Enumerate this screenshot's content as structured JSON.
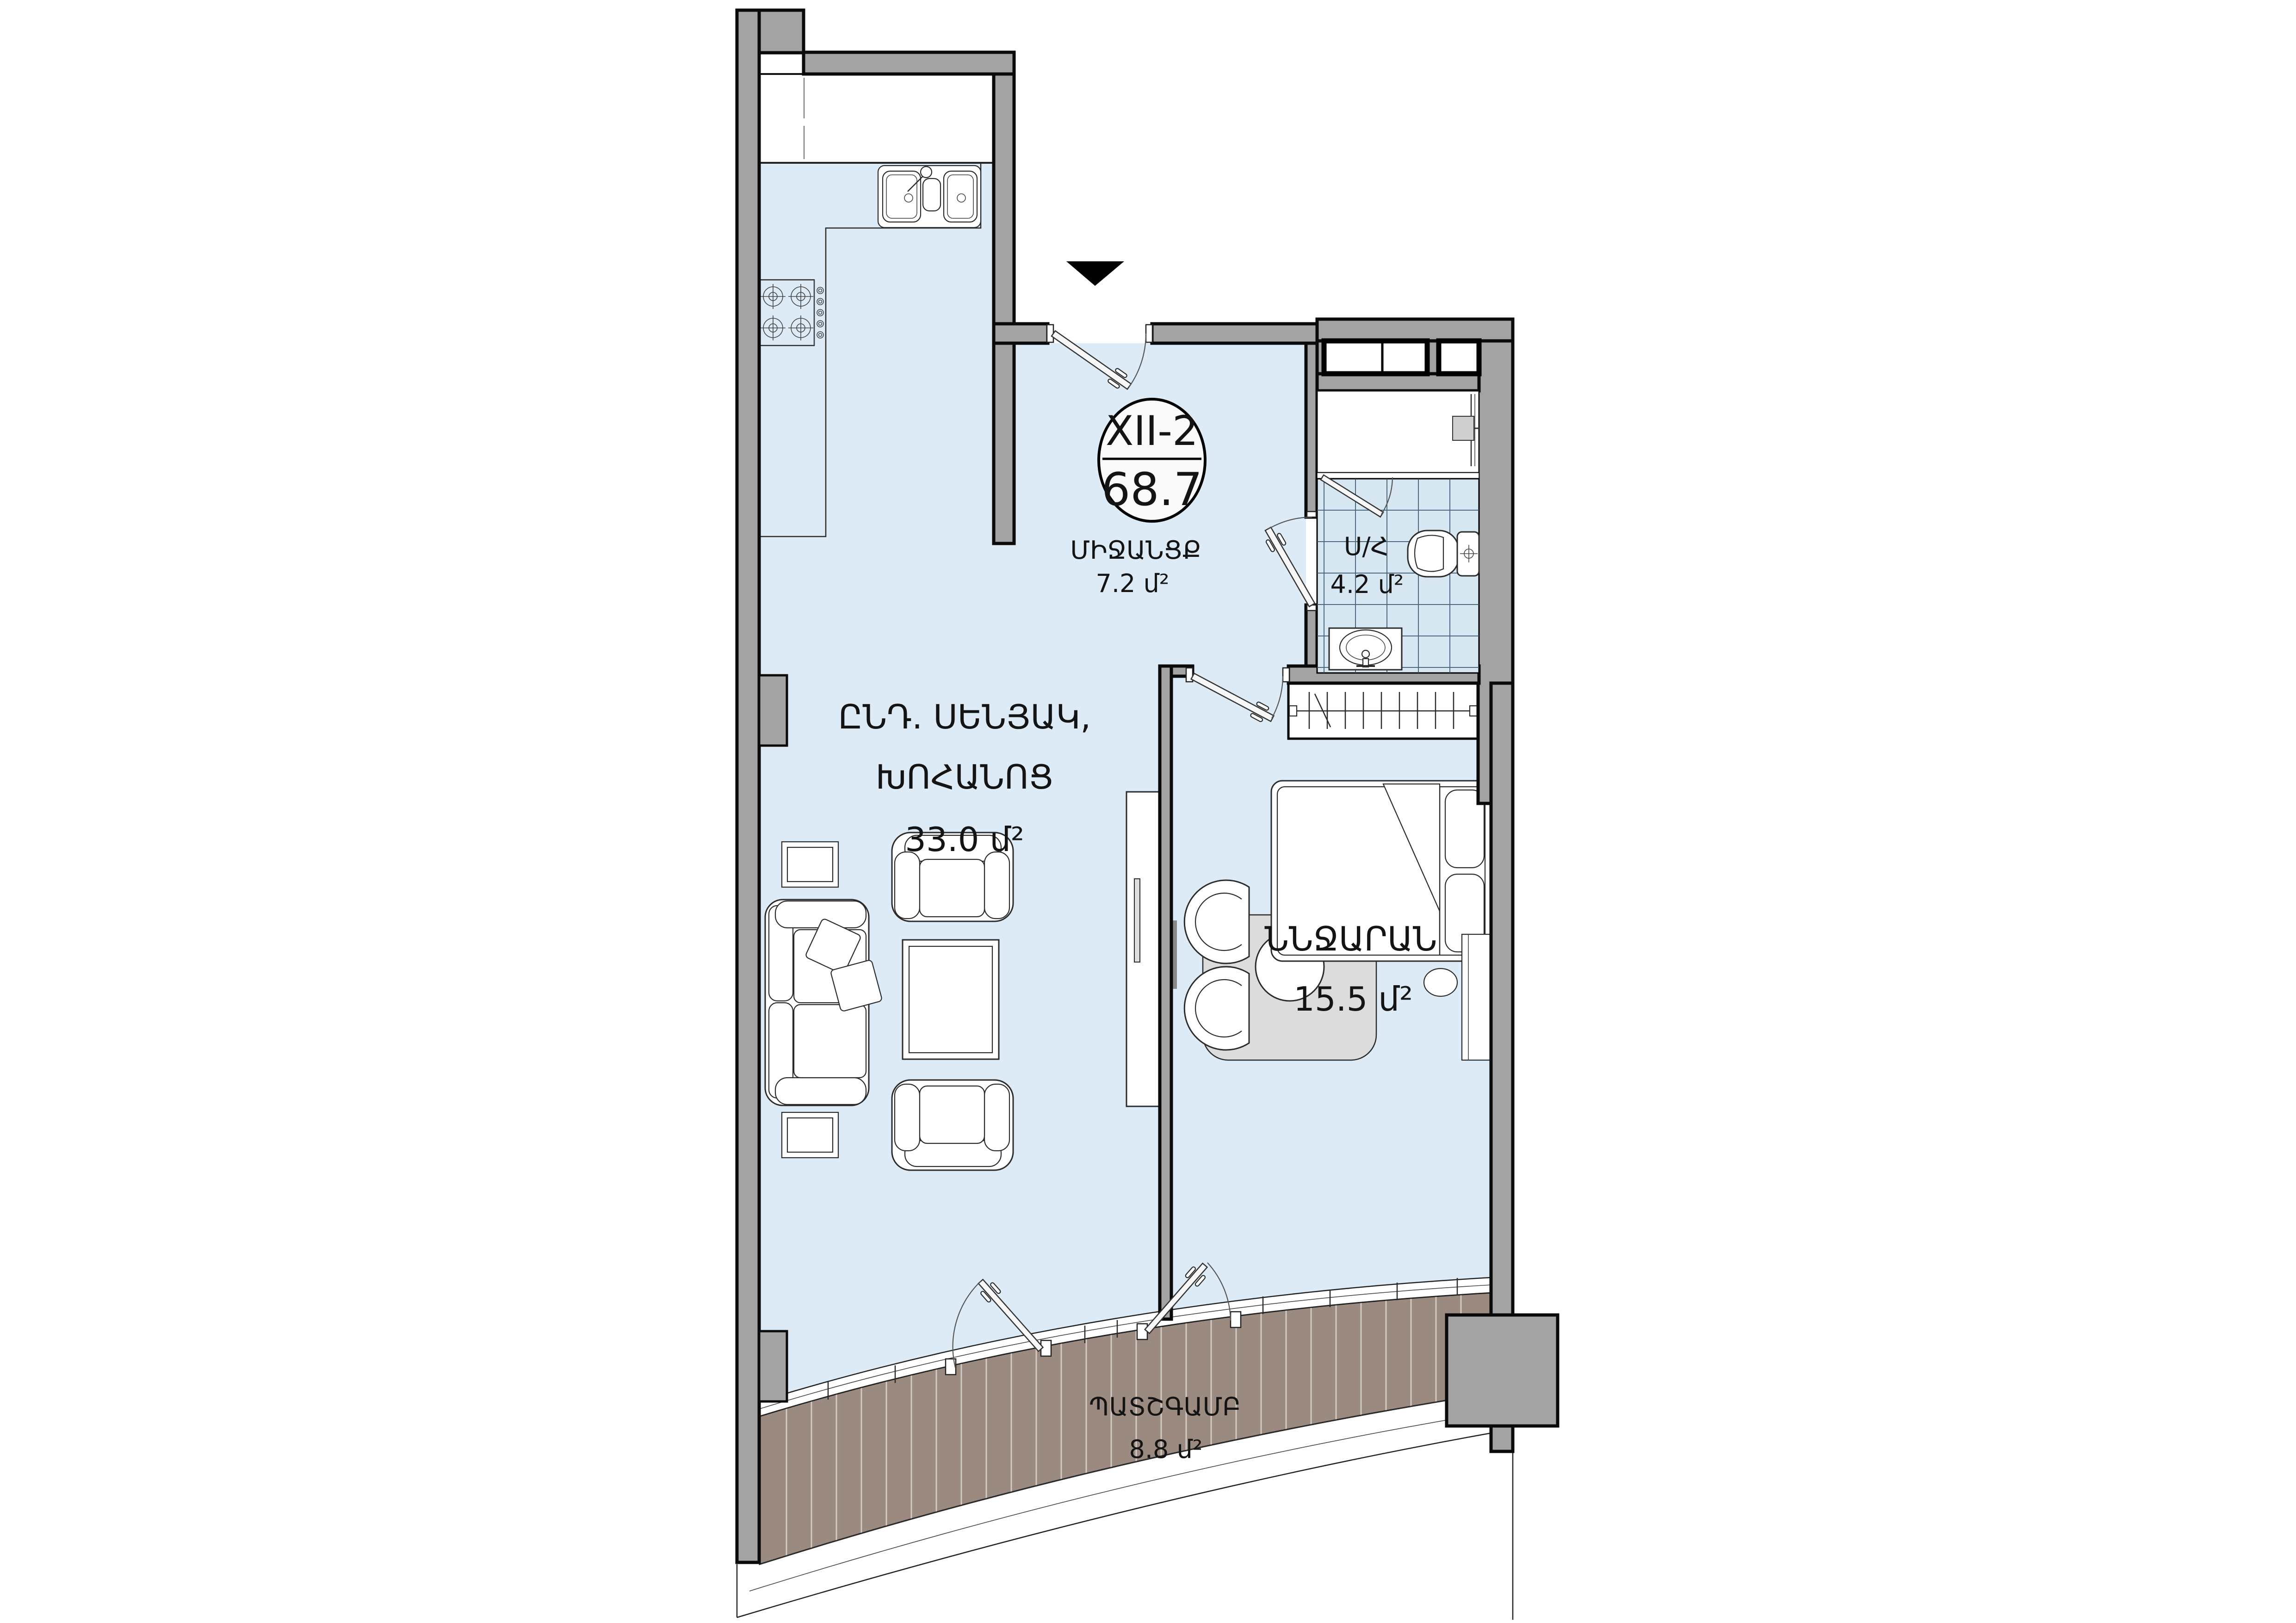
{
  "title": "Apartment floor plan",
  "badge": {
    "unit": "XII-2",
    "total_area": "68.7"
  },
  "rooms": {
    "corridor": {
      "name": "ՄԻՋԱՆՑՔ",
      "area": "7.2 մ²"
    },
    "living": {
      "name_line1": "ԸՆԴ. ՍԵՆՅԱԿ,",
      "name_line2": "ԽՈՀԱՆՈՑ",
      "area": "33.0 մ²"
    },
    "bathroom": {
      "name": "Ս/Հ",
      "area": "4.2 մ²"
    },
    "bedroom": {
      "name": "ՆՆՋԱՐԱՆ",
      "area": "15.5 մ²"
    },
    "balcony": {
      "name": "ՊԱՏՇԳԱՄԲ",
      "area": "8.8 մ²"
    }
  },
  "icons": {
    "entrance_marker": "entrance-arrow-icon",
    "fixtures": [
      "kitchen-sink-icon",
      "stove-icon",
      "toilet-icon",
      "washbasin-icon",
      "shower-icon",
      "wardrobe-icon",
      "bed-icon",
      "sofa-icon",
      "armchair-icon",
      "coffee-table-icon",
      "side-table-icon",
      "tv-console-icon",
      "round-table-icon",
      "tub-chair-icon",
      "desk-icon",
      "stool-icon",
      "door-icon"
    ]
  },
  "colors": {
    "wall": "#a3a3a3",
    "floor": "#dcebf5",
    "tile_floor": "#d7e7f2",
    "deck": "#9a8a7f",
    "rug": "#dcdcdc",
    "line": "#1c1c1c"
  }
}
